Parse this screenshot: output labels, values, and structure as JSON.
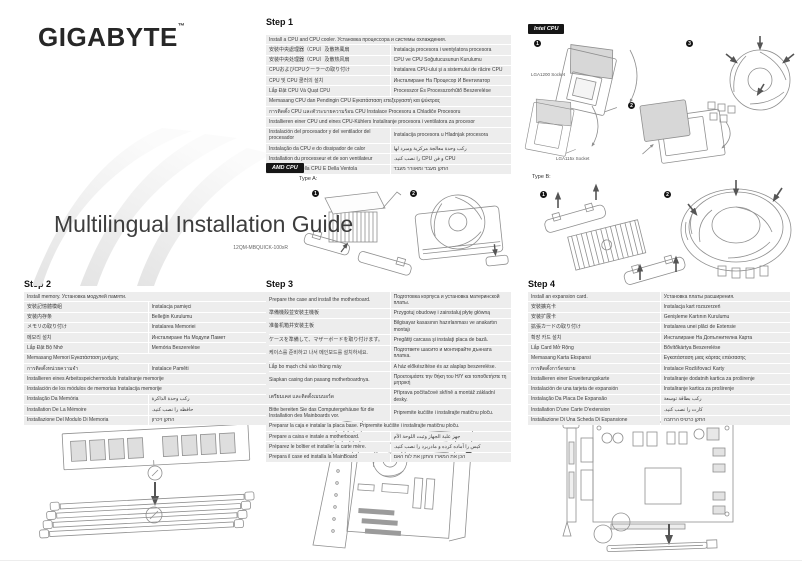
{
  "logo": {
    "text": "GIGABYTE",
    "tm": "™"
  },
  "title": {
    "text": "Multilingual Installation Guide",
    "part_number": "12QM-MBQUICK-100xR"
  },
  "badges": {
    "intel": "Intel CPU",
    "amd": "AMD CPU"
  },
  "diagrams": {
    "intel": {
      "n1": "1",
      "n2": "2",
      "n3": "3",
      "socket_top": "LGA1200 Socket",
      "socket_bottom": "LGA115x Socket"
    },
    "amd": {
      "type_a_label": "Type A:",
      "n1": "1",
      "n2": "2"
    },
    "type_b": {
      "label": "Type B:",
      "n1": "1",
      "n2": "2"
    }
  },
  "steps": [
    {
      "title": "Step 1",
      "rows": [
        {
          "span": true,
          "l": "Install a CPU and CPU cooler. Установка процессора и системы охлаждения."
        },
        {
          "l": "安裝中央處理器（CPU）及散熱風扇",
          "r": "Instalacja procesora i wentylatora procesora"
        },
        {
          "l": "安装中央处理器（CPU）及散热风扇",
          "r": "CPU ve CPU Soğutucusunun Kurulumu"
        },
        {
          "l": "CPUおよびCPUクーラーの取り付け",
          "r": "Instalarea CPU-ului şi a sistemului de răcire CPU"
        },
        {
          "l": "CPU 및 CPU 쿨러의 설치",
          "r": "Инсталиране На Процесор И Вентилатор"
        },
        {
          "l": "Lắp Đặt CPU Và Quạt CPU",
          "r": "Processzor És Processzorhűtő Beszerelése"
        },
        {
          "span": true,
          "l": "Memasang CPU dan Pendingin CPU Εγκατάσταση επεξεργαστή και ψύκτρας"
        },
        {
          "span": true,
          "l": "การติดตั้ง CPU และตัวระบายความร้อน CPU Instalace Procesoru a Chladiče Procesoru"
        },
        {
          "span": true,
          "l": "Installieren einer CPU und eines CPU-Kühlers Instaliranje procesora i ventilatora za procesor"
        },
        {
          "l": "Instalación del procesador y del ventilador del procesador",
          "r": "Instalacija procesora u Hladnjak procesora"
        },
        {
          "l": "Instalação da CPU e do dissipador de calor",
          "r": "ركب وحدة معالجة مركزية ومبرد لها",
          "rtl": true
        },
        {
          "l": "Installation du processeur et de son ventilateur",
          "r": "CPU و فن CPU را نصب كنيد.",
          "rtl": true
        },
        {
          "l": "Installazione Della CPU E Della Ventola",
          "r": "התקן מעבד ומאוורר מעבד",
          "rtl": true
        }
      ]
    },
    {
      "title": "Step 2",
      "rows": [
        {
          "span": true,
          "l": "Install memory. Установка модулей памяти."
        },
        {
          "l": "安裝記憶體模組",
          "r": "Instalacja pamięci"
        },
        {
          "l": "安装内存条",
          "r": "Belleğin Kurulumu"
        },
        {
          "l": "メモリの取り付け",
          "r": "Instalarea Memoriei"
        },
        {
          "l": "메모리 설치",
          "r": "Инсталиране На Модули Памет"
        },
        {
          "l": "Lắp Đặt Bộ Nhớ",
          "r": "Memória Beszerelése"
        },
        {
          "span": true,
          "l": "Memasang Memori Εγκατάσταση μνήμης"
        },
        {
          "l": "การติดตั้งหน่วยความจำ",
          "r": "Instalace Paměti"
        },
        {
          "span": true,
          "l": "Installieren eines Arbeitsspeichermoduls Instaliranje memorije"
        },
        {
          "span": true,
          "l": "Instalación de los módulos de memorias Instalacija memorije"
        },
        {
          "l": "Instalação Da Memória",
          "r": "ركب وحدة الذاكرة",
          "rtl": true
        },
        {
          "l": "Installation De La Mémoire",
          "r": "حافظه را نصب كنيد.",
          "rtl": true
        },
        {
          "l": "Installazione Del Modulo Di Memoria",
          "r": "התקן זיכרון",
          "rtl": true
        }
      ]
    },
    {
      "title": "Step 3",
      "rows": [
        {
          "l": "Prepare the case and install the motherboard.",
          "r": "Подготовка корпуса и установка материнской платы."
        },
        {
          "l": "準備機殼並安裝主機板",
          "r": "Przygotuj obudowę i zainstaluj płytę główną"
        },
        {
          "l": "准备机箱并安装主板",
          "r": "Bilgisayar kasasının hazırlanması ve anakartın montajı"
        },
        {
          "l": "ケースを準備して、マザーボードを取り付けます。",
          "r": "Pregătiţi carcasa şi instalaţi placa de bază."
        },
        {
          "l": "케이스를 준비하고 나서 메인보드를 설치하세요.",
          "r": "Подгответе шасито и монтирайте дънната платка."
        },
        {
          "l": "Lắp bo mạch chủ vào thùng máy",
          "r": "A ház előkészítése és az alaplap beszerelése."
        },
        {
          "l": "Siapkan casing dan pasang motherboardnya.",
          "r": "Προετοιμάστε την θήκη του Η/Υ και τοποθετήστε τη μητρική"
        },
        {
          "l": "เตรียมเคส และติดตั้งเมนบอร์ด",
          "r": "Příprava počítačové skříně a montáž základní desky."
        },
        {
          "l": "Bitte bereiten Sie das Computergehäuse für die Installation des Mainboards vor.",
          "r": "Pripremite kućište i instalirajte matičnu ploču."
        },
        {
          "span": true,
          "l": "Preparar la caja e instalar la placa base. Pripremite kućište i instalirajte matičnu ploču."
        },
        {
          "l": "Prepare a caixa e instale a motherboard.",
          "r": "جهز علبة الجهاز وثبت اللوحة الأم",
          "rtl": true
        },
        {
          "l": "Préparez le boîtier et installer la carte mère.",
          "r": "كيس را آماده كرده و مادربرد را نصب كنيد.",
          "rtl": true
        },
        {
          "l": "Prepara il case ed installa la MainBoard",
          "r": "הכן את המארז והתקן את לוח האם",
          "rtl": true
        }
      ]
    },
    {
      "title": "Step 4",
      "rows": [
        {
          "l": "Install an expansion card.",
          "r": "Установка платы расширения."
        },
        {
          "l": "安裝擴充卡",
          "r": "Instalacja kart rozszerzeń"
        },
        {
          "l": "安装扩展卡",
          "r": "Genişleme Kartının Kurulumu"
        },
        {
          "l": "拡張カードの取り付け",
          "r": "Instalarea unei plăci de Extensie"
        },
        {
          "l": "확장 카드 설치",
          "r": "Инсталиране На Допълнителна Карта"
        },
        {
          "l": "Lắp Card Mở Rộng",
          "r": "Bővítőkártya Beszerelése"
        },
        {
          "l": "Memasang Karta Ekspansi",
          "r": "Εγκατάσταση μιας κάρτας επέκτασης"
        },
        {
          "l": "การติดตั้งการ์ดขยาย",
          "r": "Instalace Rozšiřovací Karty"
        },
        {
          "l": "Installieren einer Erweiterungskarte",
          "r": "Instaliranje dodatnih kartica za proširenje"
        },
        {
          "l": "Instalación de una tarjeta de expansión",
          "r": "Instaliranje kartica za proširenje"
        },
        {
          "l": "Instalação Da Placa De Expansão",
          "r": "ركب بطاقة توسعة",
          "rtl": true
        },
        {
          "l": "Installation D'une Carte D'extension",
          "r": "كارت را نصب كنيد.",
          "rtl": true
        },
        {
          "l": "Installazione Di Una Scheda Di Espansione",
          "r": "התקן כרטיס הרחבה",
          "rtl": true
        }
      ]
    }
  ]
}
